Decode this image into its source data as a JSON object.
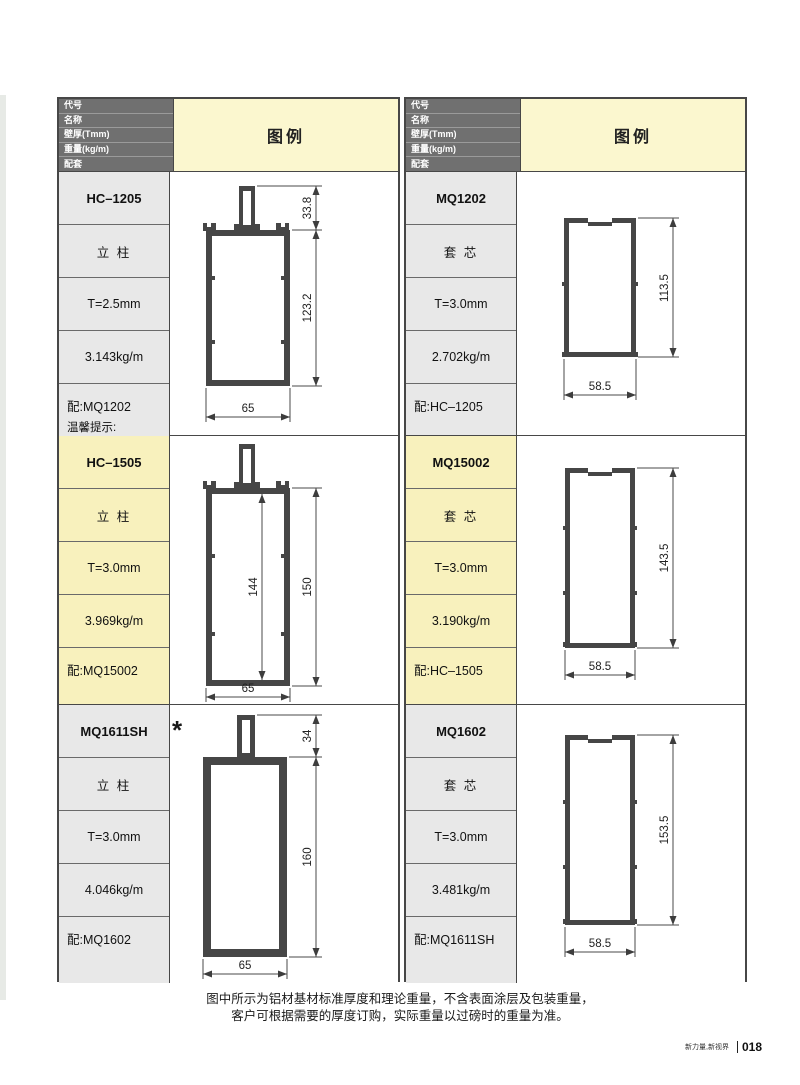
{
  "header": {
    "fields": [
      "代号",
      "名称",
      "壁厚(Tmm)",
      "重量(kg/m)",
      "配套"
    ],
    "legend": "图例"
  },
  "cols": [
    {
      "rows": [
        {
          "code": "HC–1205",
          "name": "立 柱",
          "thk": "T=2.5mm",
          "wt": "3.143kg/m",
          "match": "配:MQ1202",
          "note1": "温馨提示:",
          "note2": "HC–1205–2.5",
          "note3": "2.5和3.0有点不同",
          "fig": {
            "dim_stem": "33.8",
            "dim_body": "123.2",
            "dim_width": "65"
          }
        },
        {
          "code": "HC–1505",
          "name": "立 柱",
          "thk": "T=3.0mm",
          "wt": "3.969kg/m",
          "match": "配:MQ15002",
          "fig": {
            "dim_inner": "144",
            "dim_body": "150",
            "dim_width": "65"
          }
        },
        {
          "code": "MQ1611SH",
          "name": "立 柱",
          "thk": "T=3.0mm",
          "wt": "4.046kg/m",
          "match": "配:MQ1602",
          "mark": "*",
          "fig": {
            "dim_stem": "34",
            "dim_body": "160",
            "dim_width": "65"
          }
        }
      ]
    },
    {
      "rows": [
        {
          "code": "MQ1202",
          "name": "套 芯",
          "thk": "T=3.0mm",
          "wt": "2.702kg/m",
          "match": "配:HC–1205",
          "fig": {
            "dim_body": "113.5",
            "dim_width": "58.5"
          }
        },
        {
          "code": "MQ15002",
          "name": "套 芯",
          "thk": "T=3.0mm",
          "wt": "3.190kg/m",
          "match": "配:HC–1505",
          "fig": {
            "dim_body": "143.5",
            "dim_width": "58.5"
          }
        },
        {
          "code": "MQ1602",
          "name": "套 芯",
          "thk": "T=3.0mm",
          "wt": "3.481kg/m",
          "match": "配:MQ1611SH",
          "fig": {
            "dim_body": "153.5",
            "dim_width": "58.5"
          }
        }
      ]
    }
  ],
  "footer": {
    "note1": "图中所示为铝材基材标准厚度和理论重量，不含表面涂层及包装重量，",
    "note2": "客户可根据需要的厚度订购，实际重量以过磅时的重量为准。",
    "brand": "新力量,新视界",
    "page": "018"
  },
  "colors": {
    "header_bg": "#707070",
    "legend_bg": "#fbf7cf",
    "label_gray": "#e8e8e8",
    "highlight_yellow": "#f8f1bd",
    "profile": "#464646"
  }
}
